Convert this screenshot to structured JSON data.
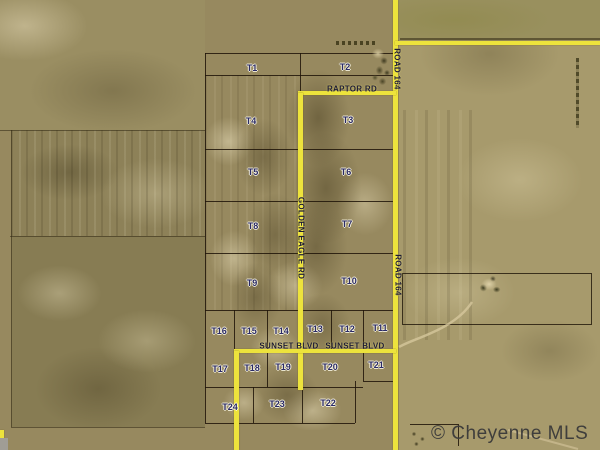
{
  "map": {
    "tracts": [
      {
        "label": "T1"
      },
      {
        "label": "T2"
      },
      {
        "label": "T3"
      },
      {
        "label": "T4"
      },
      {
        "label": "T5"
      },
      {
        "label": "T6"
      },
      {
        "label": "T7"
      },
      {
        "label": "T8"
      },
      {
        "label": "T9"
      },
      {
        "label": "T10"
      },
      {
        "label": "T11"
      },
      {
        "label": "T12"
      },
      {
        "label": "T13"
      },
      {
        "label": "T14"
      },
      {
        "label": "T15"
      },
      {
        "label": "T16"
      },
      {
        "label": "T17"
      },
      {
        "label": "T18"
      },
      {
        "label": "T19"
      },
      {
        "label": "T20"
      },
      {
        "label": "T21"
      },
      {
        "label": "T22"
      },
      {
        "label": "T23"
      },
      {
        "label": "T24"
      }
    ],
    "roads": {
      "raptor": "RAPTOR RD",
      "road164_top": "ROAD 164",
      "road164_mid": "ROAD 164",
      "golden_eagle": "GOLDEN EAGLE RD",
      "sunset_west": "SUNSET BLVD",
      "sunset_east": "SUNSET BLVD"
    },
    "watermark": "© Cheyenne MLS",
    "colors": {
      "road_yellow": "#ede33c",
      "parcel_line": "#1e1408",
      "tract_label": "#2a2a66",
      "watermark_gray": "#3f3e3c",
      "terrain_base": "#97895f"
    }
  }
}
